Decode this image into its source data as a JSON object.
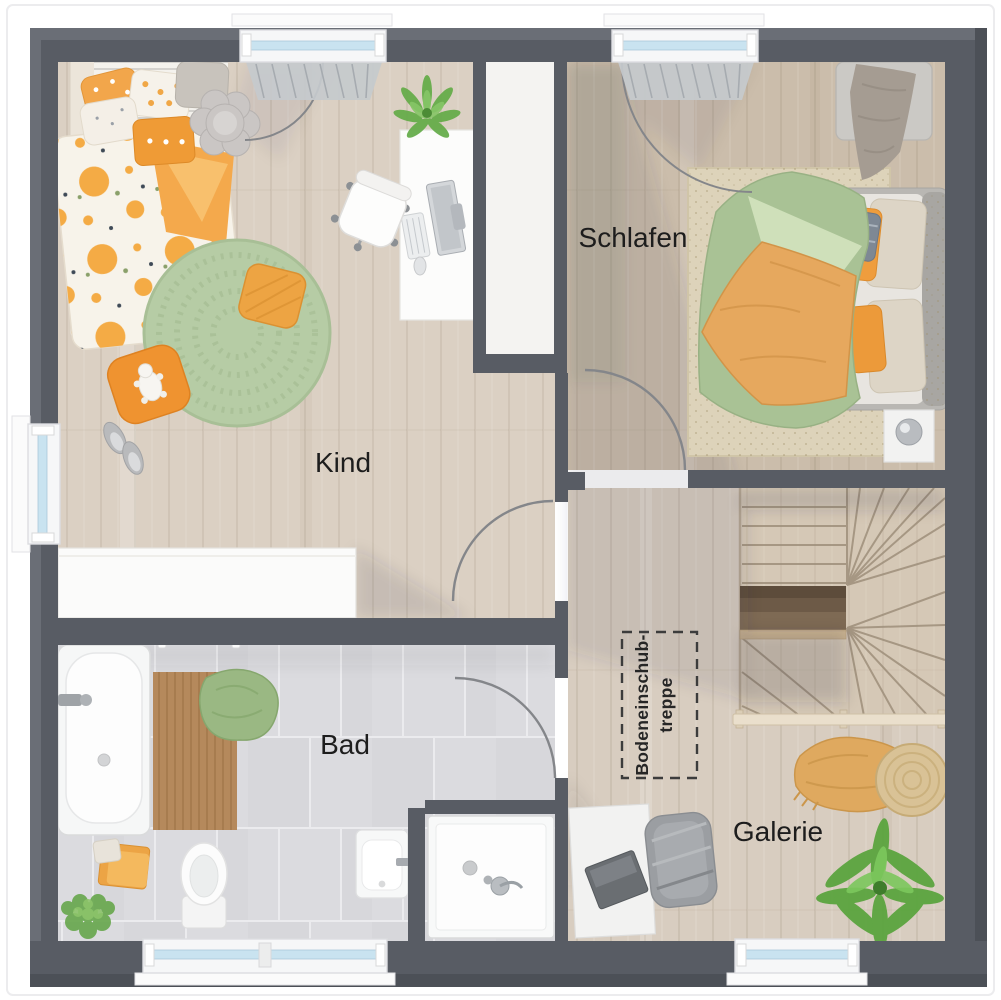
{
  "plan": {
    "type": "floor-plan-upper-storey",
    "rooms": {
      "kind": {
        "label": "Kind"
      },
      "schlafen": {
        "label": "Schlafen"
      },
      "bad": {
        "label": "Bad"
      },
      "galerie": {
        "label": "Galerie"
      }
    },
    "annotations": {
      "attic_stairs": {
        "line1": "Bodeneinschub-",
        "line2": "treppe"
      }
    },
    "colors": {
      "wall": "#585c64",
      "wood_floor": "#dbd0c3",
      "wood_floor_bedroom": "#cbbdab",
      "stair_wood": "#d5c8b6",
      "tile_floor": "#dbdbdf",
      "window_glass": "#c9e3f0",
      "accent_orange": "#f0a344",
      "accent_sage_green": "#a9c295",
      "rug_green": "#b6cca5"
    }
  }
}
